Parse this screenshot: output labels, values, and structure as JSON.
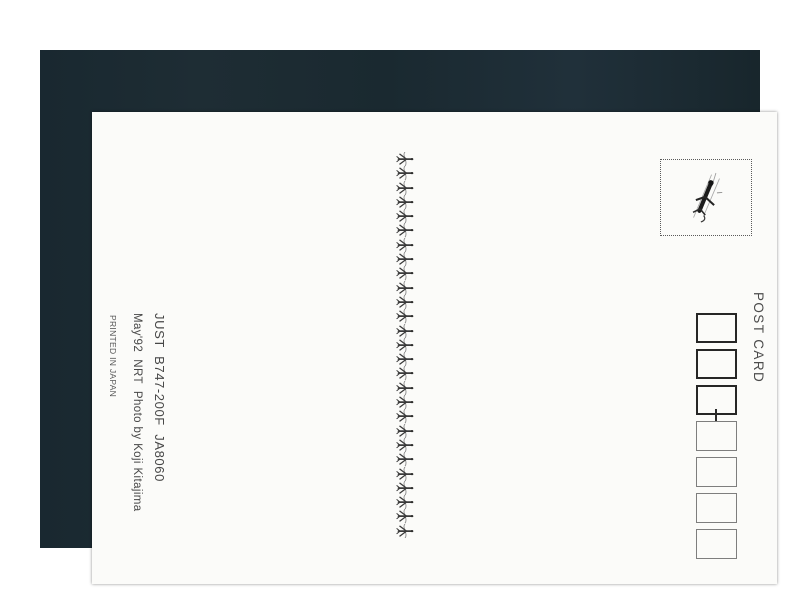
{
  "postcard": {
    "post_card_label": "POST CARD",
    "credits": {
      "line1": "JUST  B747-200F  JA8060",
      "line2": "May'92  NRT  Photo by Koji Kitajima",
      "line3": "PRINTED IN JAPAN"
    },
    "stamp_area": {
      "icon": "airplane-sketch-icon",
      "border_style": "dotted"
    },
    "divider": {
      "icon": "airplane-icon",
      "plane_count": 27
    },
    "postal_code": {
      "thick_box_count": 3,
      "thin_box_count": 4,
      "separator": "-"
    },
    "colors": {
      "frame_background": "#1c2a31",
      "page_background": "#ffffff",
      "card_background": "#fbfbf9",
      "text": "#474747",
      "thick_box_border": "#262626",
      "thin_box_border": "#7e7e7e"
    }
  }
}
